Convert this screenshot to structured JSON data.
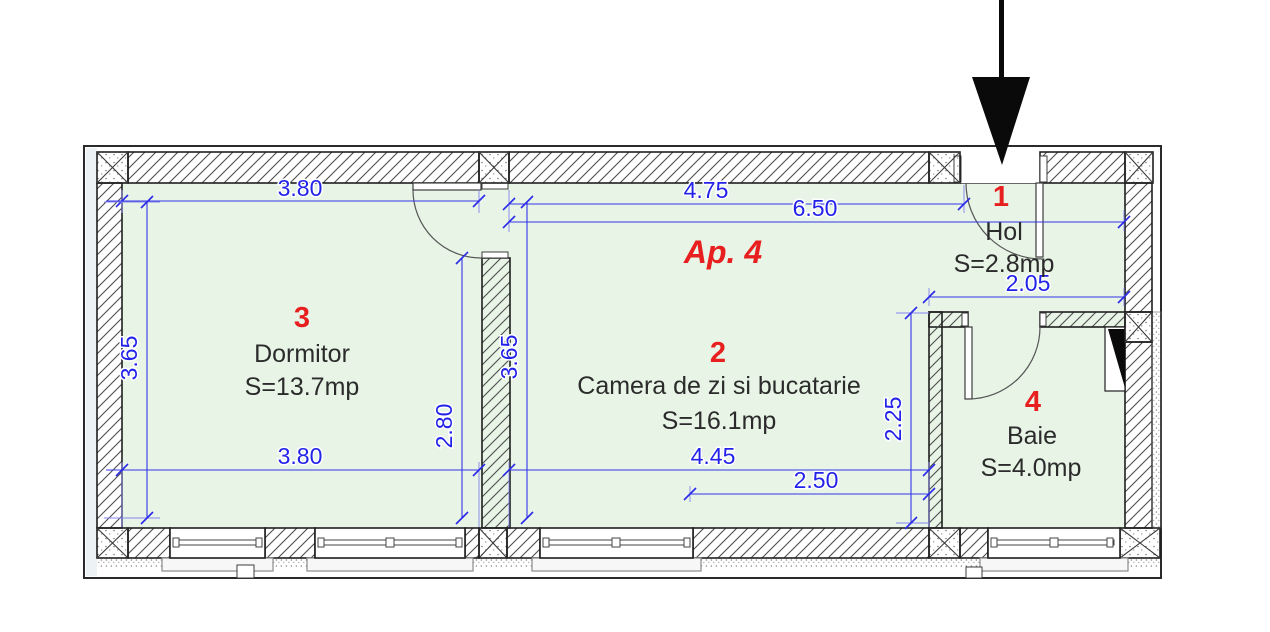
{
  "plan": {
    "apartment_label": "Ap. 4",
    "rooms": [
      {
        "number": "1",
        "name": "Hol",
        "area": "S=2.8mp"
      },
      {
        "number": "2",
        "name": "Camera de zi si bucatarie",
        "area": "S=16.1mp"
      },
      {
        "number": "3",
        "name": "Dormitor",
        "area": "S=13.7mp"
      },
      {
        "number": "4",
        "name": "Baie",
        "area": "S=4.0mp"
      }
    ],
    "dimensions": {
      "dormitor_width_top": "3.80",
      "living_width_top": "4.75",
      "living_hol_total_width": "6.50",
      "hol_width": "2.05",
      "dormitor_height_left": "3.65",
      "living_height_left": "3.65",
      "door_wall_height": "2.80",
      "baie_height": "2.25",
      "dormitor_width_bottom": "3.80",
      "living_width_bottom": "4.45",
      "living_width_partial_bottom": "2.50"
    },
    "icons": {
      "entrance_arrow": "solid-down-arrow"
    },
    "colors": {
      "floor_green": "#e7f4e6",
      "dimension_blue": "#2222e8",
      "room_number_red": "#e81f1f",
      "label_dark": "#2b2b2b",
      "wall_line": "#1f1f1f"
    }
  }
}
